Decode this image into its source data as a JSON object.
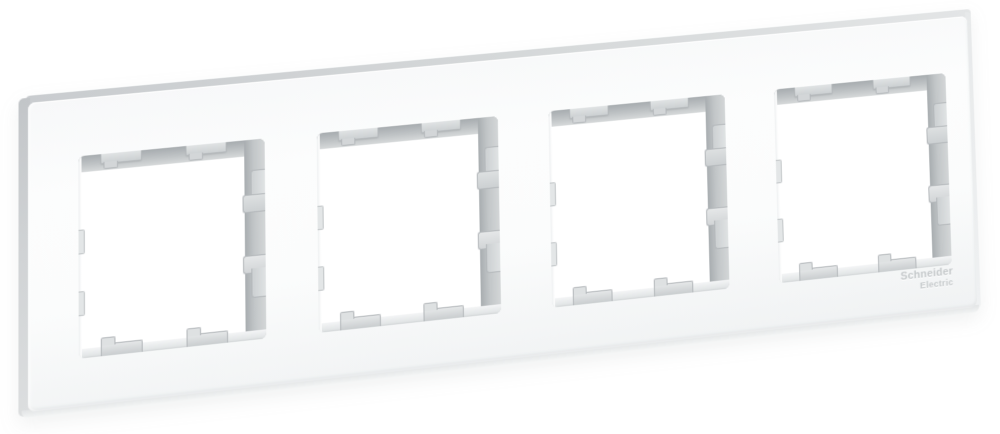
{
  "page": {
    "background_color": "#ffffff",
    "description": "Angled product photo of a white 4-gang wall switch frame"
  },
  "frame": {
    "color_name": "white",
    "openings_count": 4,
    "clips_per_opening": {
      "top": 2,
      "bottom": 2,
      "left": 2,
      "right": 2
    },
    "logo": {
      "line1": "Schneider",
      "line2": "Electric"
    },
    "colors": {
      "face": "#fbfcfc",
      "top_edge": "#d2d5d7",
      "left_edge": "#c8cbcd",
      "inner_wall_dark": "#a8adb0",
      "inner_wall_light": "#d3d6d7",
      "clip_tab": "#d6d9db",
      "logo_text": "#c4c8ca"
    }
  }
}
